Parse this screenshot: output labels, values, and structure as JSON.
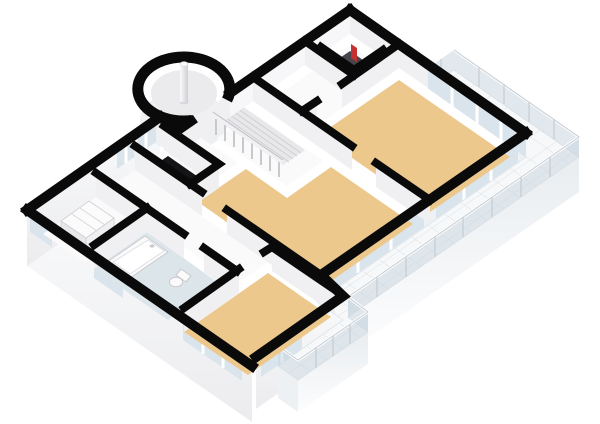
{
  "scene": {
    "type": "3d-floorplan-render",
    "view": "axonometric-birdseye-southeast",
    "style": "cutaway-walls-black-tops",
    "background": "#ffffff"
  },
  "colors": {
    "background": "#ffffff",
    "wallTop": "#0a0a0a",
    "facade": "#f6f7f8",
    "facadeShade": "#e7e9ec",
    "interiorFace": "#f0f0f3",
    "interiorFaceLight": "#f7f7f9",
    "floorWood": "#ecc88d",
    "floorBath": "#dce6ea",
    "floorHall": "#fafafb",
    "tile": "#f6f8f9",
    "tileLine": "#dce1e5",
    "glass": "#d9e4ec",
    "glassRail": "rgba(198,212,222,0.5)",
    "railPost": "#c5ccd2",
    "voidDark": "#151517",
    "nicheDark": "#45454b",
    "deviceRed": "#c43131",
    "fixture": "#fbfbfc",
    "fixtureLine": "#c9c9ce",
    "stairTread": "#e8e8ea",
    "treadLine": "#cfcfd4",
    "baluster": "#c9c9cd",
    "columnWhite": "#fafafa",
    "columnShade": "#d8d8dc"
  },
  "rooms": {
    "entryHall": {
      "name": "Entry hall",
      "floor": "white"
    },
    "techCloset": {
      "name": "Technical closet",
      "floor": "dark",
      "object": "red boiler device"
    },
    "livingUpper": {
      "name": "Living room",
      "floor": "wood"
    },
    "familyRoom": {
      "name": "Living / dining room",
      "floor": "wood"
    },
    "landing": {
      "name": "Stair landing",
      "floor": "white"
    },
    "stairVoid": {
      "name": "Stairwell void",
      "floor": "open-black"
    },
    "hallway": {
      "name": "Hallway",
      "floor": "white"
    },
    "bathroom": {
      "name": "Bathroom",
      "floor": "blue",
      "objects": [
        "bathtub",
        "toilet"
      ]
    },
    "utility": {
      "name": "Utility room",
      "floor": "white",
      "objects": [
        "washing-machine"
      ]
    },
    "bedroom": {
      "name": "Bedroom",
      "floor": "wood"
    },
    "turret": {
      "name": "Round turret",
      "objects": [
        "chimney-column"
      ]
    },
    "terrace": {
      "name": "Wrap-around terrace",
      "floor": "white-tiles",
      "railing": "glass"
    },
    "balconySmall": {
      "name": "Small balcony",
      "floor": "white-tiles",
      "railing": "glass"
    }
  },
  "objects": [
    "bathtub",
    "toilet",
    "washing-machine",
    "chimney-column",
    "staircase",
    "stair-balustrade",
    "boiler-device",
    "window-bands",
    "glass-railing"
  ]
}
